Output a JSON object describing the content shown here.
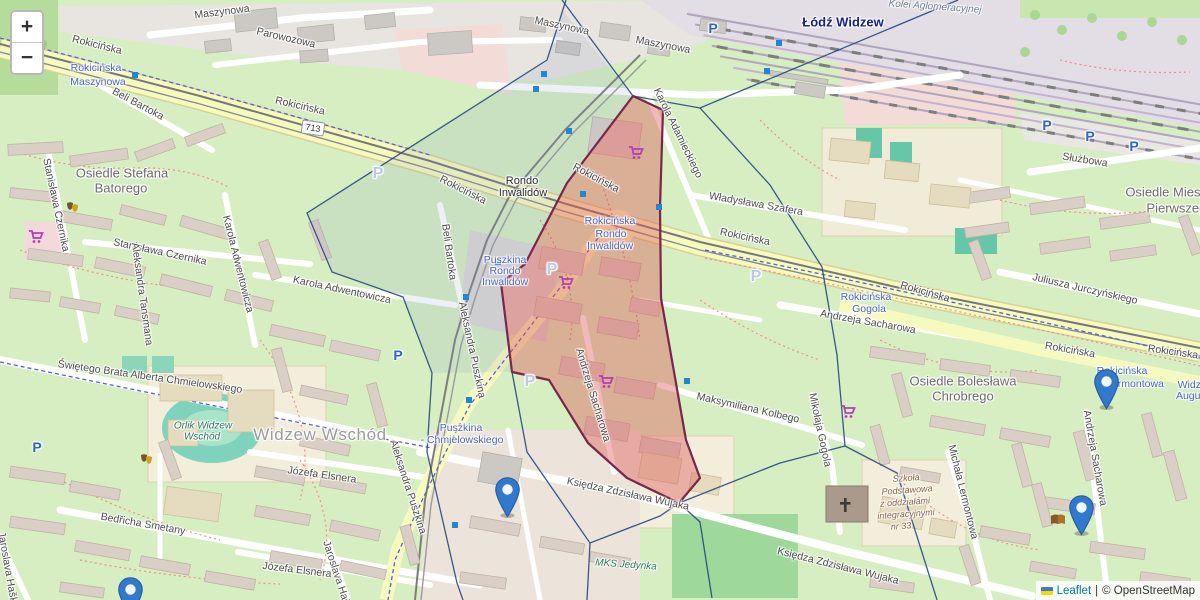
{
  "attribution": {
    "leaflet": "Leaflet",
    "sep": "|",
    "osm": "© OpenStreetMap"
  },
  "zoom_control": {
    "zoom_in": "+",
    "zoom_out": "−"
  },
  "shield": {
    "text": "713",
    "x": 313,
    "y": 128
  },
  "colors": {
    "marker_blue": "#3179cd",
    "marker_stroke": "#2a5d9e",
    "boundary_blue": "#27477f",
    "transit_square_blue": "#1f87d4",
    "red_zone_fill": "rgba(222,89,89,0.42)",
    "red_zone_stroke": "#76284a",
    "cell_tint_fill": "rgba(125,148,188,0.14)"
  },
  "labels": [
    {
      "t": "Rokicińska",
      "x": 97,
      "y": 45,
      "r": 14,
      "c": "st"
    },
    {
      "t": "Rokicińska",
      "x": 300,
      "y": 106,
      "r": 13,
      "c": "st"
    },
    {
      "t": "Rokicińska",
      "x": 463,
      "y": 190,
      "r": 27,
      "c": "st"
    },
    {
      "t": "Rokicińska",
      "x": 596,
      "y": 178,
      "r": 28,
      "c": "st"
    },
    {
      "t": "Rokicińska",
      "x": 745,
      "y": 237,
      "r": 12,
      "c": "st"
    },
    {
      "t": "Rokicińska",
      "x": 925,
      "y": 292,
      "r": 16,
      "c": "st"
    },
    {
      "t": "Rokicińska",
      "x": 1070,
      "y": 350,
      "r": 10,
      "c": "st"
    },
    {
      "t": "Rokicińska",
      "x": 1173,
      "y": 352,
      "r": 8,
      "c": "st"
    },
    {
      "t": "Maszynowa",
      "x": 222,
      "y": 12,
      "r": -7,
      "c": "st"
    },
    {
      "t": "Maszynowa",
      "x": 562,
      "y": 26,
      "r": 12,
      "c": "st"
    },
    {
      "t": "Maszynowa",
      "x": 663,
      "y": 45,
      "r": 11,
      "c": "st"
    },
    {
      "t": "Parowozowa",
      "x": 286,
      "y": 38,
      "r": 13,
      "c": "st"
    },
    {
      "t": "Służbowa",
      "x": 1085,
      "y": 160,
      "r": 9,
      "c": "st"
    },
    {
      "t": "Beli Bartoka",
      "x": 138,
      "y": 104,
      "r": 28,
      "c": "st"
    },
    {
      "t": "Beli Bartoka",
      "x": 449,
      "y": 252,
      "r": 82,
      "c": "st"
    },
    {
      "t": "Stanisława Czernika",
      "x": 56,
      "y": 205,
      "r": 78,
      "c": "st"
    },
    {
      "t": "Stanisława Czernika",
      "x": 160,
      "y": 252,
      "r": 12,
      "c": "st"
    },
    {
      "t": "Karola Adwentowicza",
      "x": 238,
      "y": 264,
      "r": 76,
      "c": "st"
    },
    {
      "t": "Karola Adwentowicza",
      "x": 342,
      "y": 290,
      "r": 12,
      "c": "st"
    },
    {
      "t": "Aleksandra Tansmana",
      "x": 142,
      "y": 294,
      "r": 82,
      "c": "st"
    },
    {
      "t": "Świętego Brata Alberta Chmielowskiego",
      "x": 150,
      "y": 377,
      "r": 8,
      "c": "st"
    },
    {
      "t": "Bedřicha Smetany",
      "x": 143,
      "y": 524,
      "r": 10,
      "c": "st"
    },
    {
      "t": "Józefa Elsnera",
      "x": 322,
      "y": 475,
      "r": 8,
      "c": "st"
    },
    {
      "t": "Józefa Elsnera",
      "x": 297,
      "y": 570,
      "r": 7,
      "c": "st"
    },
    {
      "t": "Jaroslava Haška",
      "x": 8,
      "y": 570,
      "r": 80,
      "c": "st"
    },
    {
      "t": "Jaroslava Haška",
      "x": 338,
      "y": 578,
      "r": 72,
      "c": "st"
    },
    {
      "t": "Aleksandra Puszkina",
      "x": 472,
      "y": 350,
      "r": 78,
      "c": "st"
    },
    {
      "t": "Aleksandra Puszkina",
      "x": 408,
      "y": 487,
      "r": 72,
      "c": "st"
    },
    {
      "t": "Karola Adamieckiego",
      "x": 678,
      "y": 133,
      "r": 64,
      "c": "st"
    },
    {
      "t": "Władysława Szafera",
      "x": 756,
      "y": 204,
      "r": 10,
      "c": "st"
    },
    {
      "t": "Juliusza Jurczyńskiego",
      "x": 1085,
      "y": 289,
      "r": 13,
      "c": "st"
    },
    {
      "t": "Andrzeja Sacharowa",
      "x": 868,
      "y": 322,
      "r": 10,
      "c": "st"
    },
    {
      "t": "Andrzeja Sacharowa",
      "x": 593,
      "y": 395,
      "r": 73,
      "c": "st"
    },
    {
      "t": "Andrzeja Sacharowa",
      "x": 1095,
      "y": 458,
      "r": 80,
      "c": "st"
    },
    {
      "t": "Mikołaja Gogola",
      "x": 820,
      "y": 430,
      "r": 78,
      "c": "st"
    },
    {
      "t": "Maksymiliana Kolbego",
      "x": 748,
      "y": 408,
      "r": 13,
      "c": "st"
    },
    {
      "t": "Księdza Zdzisława Wujaka",
      "x": 628,
      "y": 494,
      "r": 12,
      "c": "st"
    },
    {
      "t": "Księdza Zdzisława Wujaka",
      "x": 838,
      "y": 566,
      "r": 14,
      "c": "st"
    },
    {
      "t": "Michała Lermontowa",
      "x": 963,
      "y": 492,
      "r": 76,
      "c": "st"
    },
    {
      "t": "Rondo",
      "x": 522,
      "y": 181,
      "r": 0,
      "c": "ju"
    },
    {
      "t": "Inwalidów",
      "x": 523,
      "y": 193,
      "r": 0,
      "c": "ju"
    },
    {
      "t": "Widzew Wschód",
      "x": 320,
      "y": 435,
      "r": 0,
      "c": "pll"
    },
    {
      "t": "Osiedle Stefana",
      "x": 122,
      "y": 173,
      "r": 0,
      "c": "pl"
    },
    {
      "t": "Batorego",
      "x": 121,
      "y": 188,
      "r": 0,
      "c": "pl"
    },
    {
      "t": "Osiedle Bolesława",
      "x": 963,
      "y": 381,
      "r": 0,
      "c": "pl"
    },
    {
      "t": "Chrobrego",
      "x": 963,
      "y": 396,
      "r": 0,
      "c": "pl"
    },
    {
      "t": "Osiedle Mieszka",
      "x": 1173,
      "y": 192,
      "r": 0,
      "c": "pl"
    },
    {
      "t": "Pierwszego",
      "x": 1180,
      "y": 208,
      "r": 0,
      "c": "pl"
    },
    {
      "t": "Łódź Widzew",
      "x": 843,
      "y": 22,
      "r": 0,
      "c": "sta"
    },
    {
      "t": "Kolei Aglomeracyjnej",
      "x": 935,
      "y": 7,
      "r": 4,
      "c": "rail"
    },
    {
      "t": "Orlik Widzew",
      "x": 203,
      "y": 426,
      "r": 0,
      "c": "pi"
    },
    {
      "t": "Wschód",
      "x": 202,
      "y": 437,
      "r": 0,
      "c": "pi"
    },
    {
      "t": "MKS Jedynka",
      "x": 626,
      "y": 565,
      "r": 4,
      "c": "pi"
    },
    {
      "t": "Rokicińska",
      "x": 96,
      "y": 68,
      "r": 0,
      "c": "tr"
    },
    {
      "t": "Maszynowa",
      "x": 98,
      "y": 82,
      "r": 0,
      "c": "tr"
    },
    {
      "t": "Rokicińska",
      "x": 610,
      "y": 221,
      "r": 0,
      "c": "tr"
    },
    {
      "t": "Rondo",
      "x": 611,
      "y": 234,
      "r": 0,
      "c": "tr"
    },
    {
      "t": "Inwalidów",
      "x": 610,
      "y": 246,
      "r": 0,
      "c": "tr"
    },
    {
      "t": "Puszkina",
      "x": 505,
      "y": 260,
      "r": 0,
      "c": "tr"
    },
    {
      "t": "Rondo",
      "x": 505,
      "y": 271,
      "r": 0,
      "c": "tr"
    },
    {
      "t": "Inwalidów",
      "x": 505,
      "y": 282,
      "r": 0,
      "c": "tr"
    },
    {
      "t": "Puszkina",
      "x": 461,
      "y": 428,
      "r": 0,
      "c": "tr"
    },
    {
      "t": "- Chmielowskiego",
      "x": 462,
      "y": 440,
      "r": 0,
      "c": "tr"
    },
    {
      "t": "Rokicińska",
      "x": 866,
      "y": 297,
      "r": 0,
      "c": "tr"
    },
    {
      "t": "Gogola",
      "x": 869,
      "y": 309,
      "r": 0,
      "c": "tr"
    },
    {
      "t": "Rokicińska",
      "x": 1122,
      "y": 371,
      "r": 0,
      "c": "tr"
    },
    {
      "t": "Lermontowa",
      "x": 1135,
      "y": 384,
      "r": 0,
      "c": "tr"
    },
    {
      "t": "Widzew",
      "x": 1196,
      "y": 385,
      "r": 0,
      "c": "tr"
    },
    {
      "t": "Augustów",
      "x": 1199,
      "y": 396,
      "r": 0,
      "c": "tr"
    },
    {
      "t": "Szkoła",
      "x": 906,
      "y": 478,
      "r": -4,
      "c": "sch"
    },
    {
      "t": "Podstawowa",
      "x": 907,
      "y": 490,
      "r": -4,
      "c": "sch"
    },
    {
      "t": "z oddziałami",
      "x": 905,
      "y": 502,
      "r": -4,
      "c": "sch"
    },
    {
      "t": "integracyjnymi",
      "x": 906,
      "y": 514,
      "r": -4,
      "c": "sch"
    },
    {
      "t": "nr 33",
      "x": 901,
      "y": 526,
      "r": -4,
      "c": "sch"
    }
  ],
  "parking_solid": [
    [
      37,
      447
    ],
    [
      398,
      355
    ],
    [
      713,
      28
    ],
    [
      1047,
      125
    ],
    [
      1090,
      136
    ],
    [
      1134,
      146
    ]
  ],
  "parking_faint": [
    [
      378,
      174
    ],
    [
      552,
      270
    ],
    [
      756,
      277
    ],
    [
      530,
      382
    ]
  ],
  "parking_letter": "P",
  "transit_squares": [
    [
      135,
      75
    ],
    [
      544,
      74
    ],
    [
      536,
      89
    ],
    [
      569,
      131
    ],
    [
      583,
      194
    ],
    [
      659,
      207
    ],
    [
      498,
      262
    ],
    [
      466,
      297
    ],
    [
      687,
      381
    ],
    [
      469,
      400
    ],
    [
      455,
      525
    ],
    [
      779,
      43
    ],
    [
      767,
      71
    ]
  ],
  "poi_icons": [
    {
      "type": "cart",
      "x": 635,
      "y": 153
    },
    {
      "type": "cart",
      "x": 565,
      "y": 283
    },
    {
      "type": "cart",
      "x": 605,
      "y": 382
    },
    {
      "type": "cart",
      "x": 35,
      "y": 237
    },
    {
      "type": "cart",
      "x": 847,
      "y": 412
    },
    {
      "type": "masks",
      "x": 73,
      "y": 208
    },
    {
      "type": "masks",
      "x": 147,
      "y": 460
    },
    {
      "type": "book",
      "x": 1058,
      "y": 520
    },
    {
      "type": "cross",
      "x": 845,
      "y": 505
    }
  ],
  "markers": [
    {
      "x": 507,
      "y": 518
    },
    {
      "x": 1106,
      "y": 410
    },
    {
      "x": 1081,
      "y": 536
    },
    {
      "x": 130,
      "y": 618
    }
  ],
  "red_zone": {
    "points": [
      [
        633,
        96
      ],
      [
        663,
        110
      ],
      [
        660,
        207
      ],
      [
        661,
        298
      ],
      [
        686,
        440
      ],
      [
        700,
        478
      ],
      [
        679,
        503
      ],
      [
        627,
        478
      ],
      [
        588,
        443
      ],
      [
        549,
        380
      ],
      [
        512,
        372
      ],
      [
        501,
        283
      ],
      [
        525,
        264
      ],
      [
        567,
        183
      ]
    ]
  },
  "cell_tint": {
    "points": [
      [
        562,
        10
      ],
      [
        547,
        60
      ],
      [
        307,
        213
      ],
      [
        332,
        272
      ],
      [
        403,
        297
      ],
      [
        432,
        373
      ],
      [
        512,
        372
      ],
      [
        501,
        283
      ],
      [
        525,
        264
      ],
      [
        567,
        183
      ],
      [
        633,
        96
      ]
    ]
  },
  "boundary_lines": [
    [
      [
        562,
        0
      ],
      [
        633,
        96
      ]
    ],
    [
      [
        633,
        96
      ],
      [
        700,
        108
      ],
      [
        958,
        0
      ]
    ],
    [
      [
        700,
        108
      ],
      [
        770,
        185
      ],
      [
        822,
        267
      ],
      [
        837,
        355
      ],
      [
        845,
        446
      ]
    ],
    [
      [
        845,
        446
      ],
      [
        780,
        463
      ],
      [
        679,
        503
      ]
    ],
    [
      [
        845,
        446
      ],
      [
        897,
        473
      ],
      [
        937,
        600
      ]
    ],
    [
      [
        679,
        503
      ],
      [
        700,
        522
      ],
      [
        712,
        598
      ]
    ],
    [
      [
        512,
        372
      ],
      [
        527,
        452
      ],
      [
        590,
        543
      ],
      [
        660,
        516
      ],
      [
        679,
        503
      ]
    ],
    [
      [
        590,
        543
      ],
      [
        587,
        600
      ]
    ],
    [
      [
        566,
        0
      ],
      [
        547,
        60
      ],
      [
        307,
        213
      ],
      [
        332,
        272
      ],
      [
        403,
        297
      ],
      [
        432,
        373
      ],
      [
        427,
        452
      ],
      [
        457,
        583
      ],
      [
        463,
        600
      ]
    ]
  ]
}
